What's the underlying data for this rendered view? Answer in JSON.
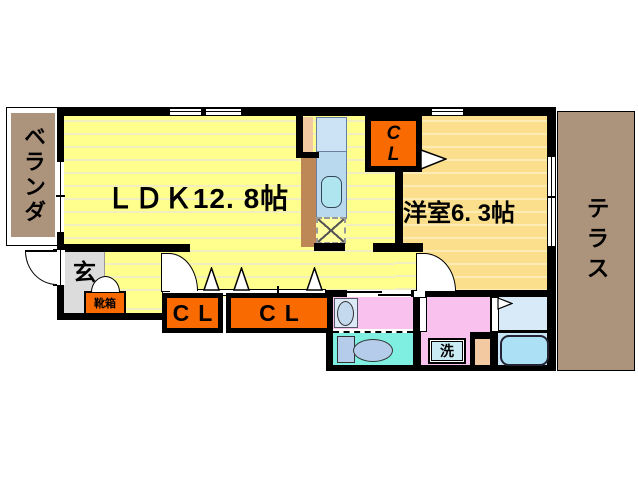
{
  "title": "1LDK apartment floor plan",
  "rooms": {
    "balcony": {
      "label": "ベランダ"
    },
    "terrace": {
      "label": "テラス"
    },
    "ldk": {
      "label": "ＬＤＫ12. 8帖",
      "size": "12.8帖"
    },
    "western_room": {
      "label": "洋室6. 3帖",
      "size": "6.3帖"
    },
    "entrance": {
      "label": "玄"
    },
    "shoe_box": {
      "label": "靴箱"
    },
    "closet_main": {
      "line1": "C",
      "line2": "L"
    },
    "closet_hall_left": {
      "label": "CL"
    },
    "closet_hall_right": {
      "label": "CL"
    },
    "laundry": {
      "label": "洗"
    }
  },
  "colors": {
    "wall": "#000000",
    "ldk_floor": "#feff8c",
    "western_floor": "#fbdf8d",
    "closet_orange": "#f96a00",
    "balcony_terrace_brown": "#ac937b",
    "entrance_gray": "#dcdcdc",
    "washroom_pink": "#f9c2ee",
    "toilet_cyan": "#7fefe2",
    "bathroom_blue": "#d8eaf8",
    "kitchen_counter_blue": "#bcdaf0",
    "fixture_peach": "#f3c9a2"
  }
}
